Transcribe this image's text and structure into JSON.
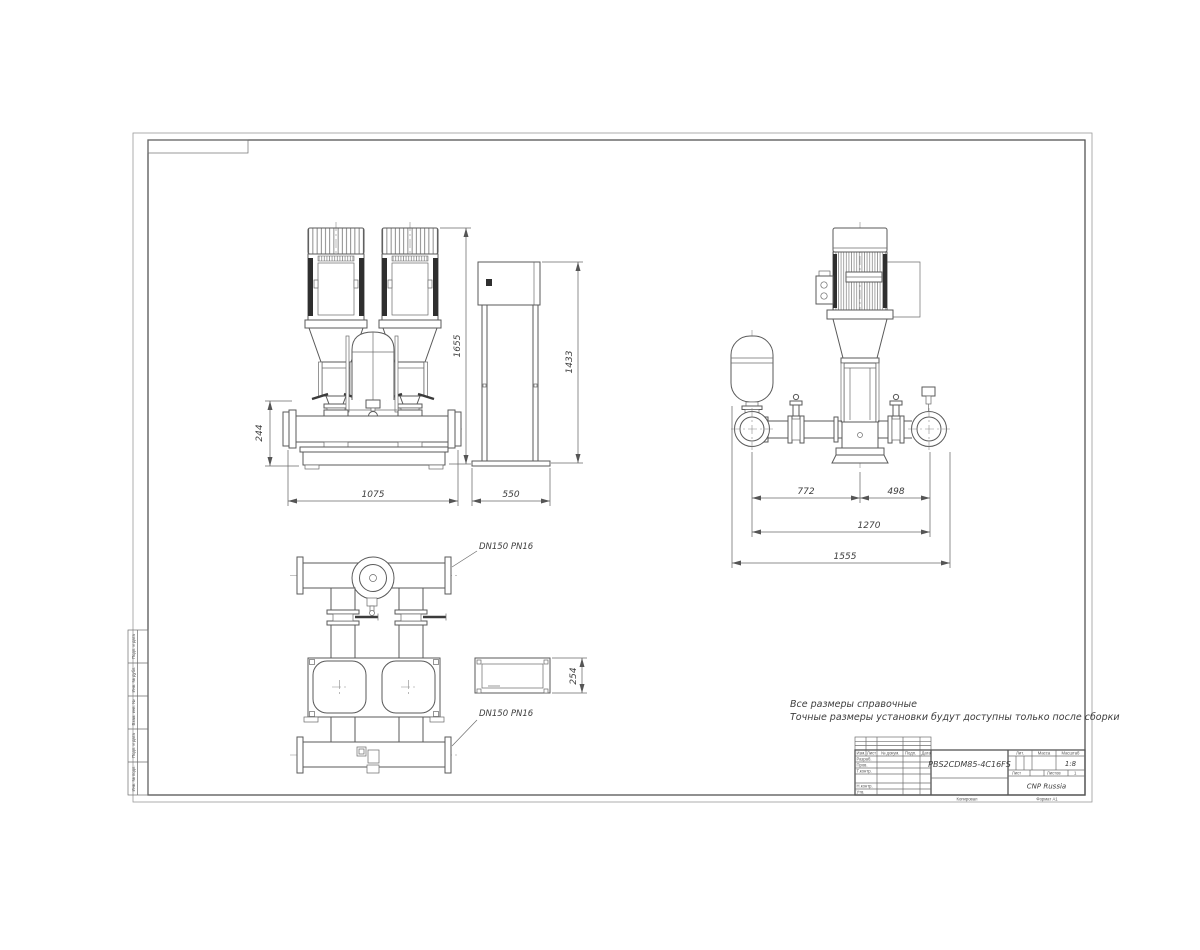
{
  "notes": {
    "line1": "Все размеры справочные",
    "line2": "Точные размеры установки будут доступны только после сборки"
  },
  "dims": {
    "front_height": "1655",
    "front_width": "1075",
    "manifold_height": "244",
    "cabinet_width": "550",
    "cabinet_height": "1433",
    "tank_to_pump": "772",
    "pump_to_flange": "498",
    "inner_span": "1270",
    "overall_width": "1555",
    "cabinet_depth": "254"
  },
  "labels": {
    "flange_top": "DN150 PN16",
    "flange_bottom": "DN150 PN16"
  },
  "title_block": {
    "designation": "PBS2CDM85-4C16FS",
    "company": "CNP Russia",
    "scale_value": "1:8",
    "header": {
      "izm": "Изм.",
      "list": "Лист",
      "no_dokum": "№ докум.",
      "podp": "Подп.",
      "data": "Дата"
    },
    "rows": {
      "razrab": "Разраб.",
      "prov": "Пров.",
      "t_kontr": "Т.контр.",
      "n_kontr": "Н.контр.",
      "utv": "Утв."
    },
    "lit_label": "Лит.",
    "massa_label": "Масса",
    "masshtab_label": "Масштаб",
    "list_label": "Лист",
    "listov_label": "Листов",
    "listov_value": "1",
    "kopiroval": "Копировал",
    "format": "Формат А1"
  },
  "margin_strip": {
    "cells": [
      "Подп. и дата",
      "Инв. № дубл.",
      "Взам. инв. №",
      "Подп. и дата",
      "Инв. № подл."
    ]
  }
}
